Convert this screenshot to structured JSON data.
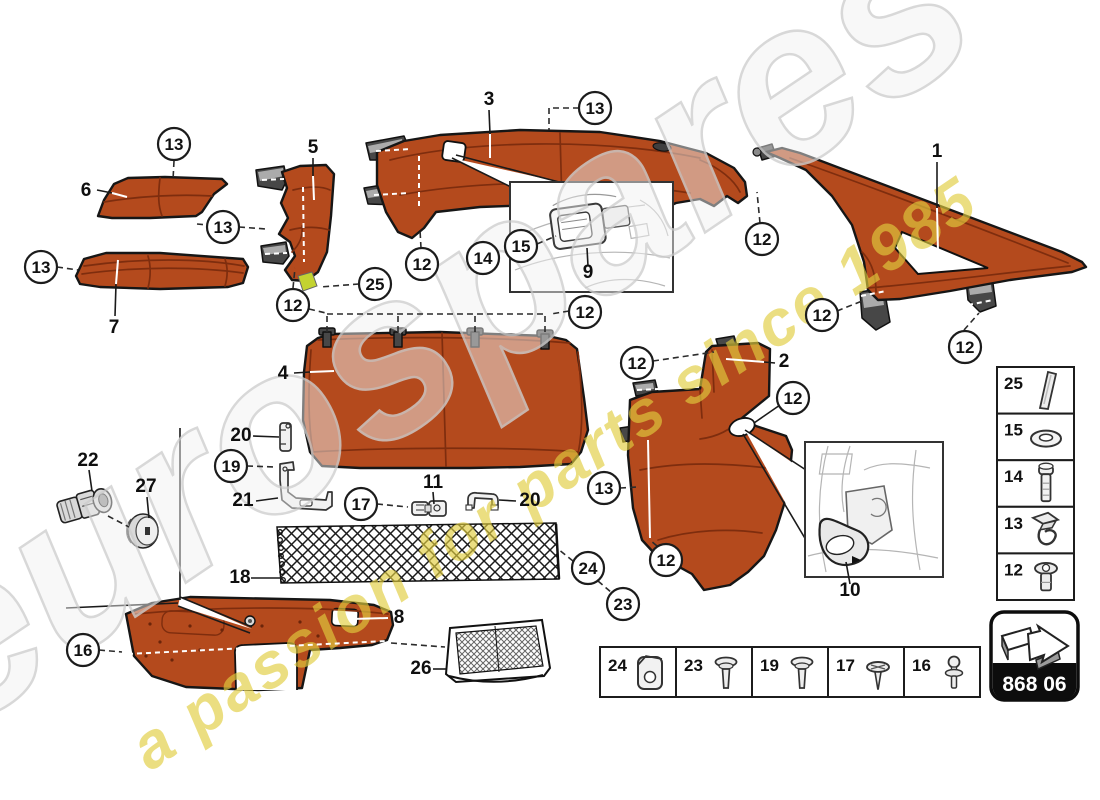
{
  "watermark": {
    "brand": "eurospares",
    "tagline": "a passion for parts since 1985",
    "tagline_color": "#e0cd3e"
  },
  "part_number_box": {
    "code": "868 06",
    "icon": "arrow-3d-icon"
  },
  "colors": {
    "trim": "#b44a1d",
    "trim_dark": "#7e2d0e",
    "outline": "#161616",
    "clip_dark": "#474747",
    "highlight_strip": "#c3d330"
  },
  "labels": [
    {
      "text": "6",
      "x": 86,
      "y": 196
    },
    {
      "text": "7",
      "x": 114,
      "y": 333
    },
    {
      "text": "5",
      "x": 313,
      "y": 153
    },
    {
      "text": "3",
      "x": 489,
      "y": 105
    },
    {
      "text": "1",
      "x": 937,
      "y": 157
    },
    {
      "text": "2",
      "x": 784,
      "y": 367
    },
    {
      "text": "4",
      "x": 283,
      "y": 379
    },
    {
      "text": "8",
      "x": 399,
      "y": 623
    },
    {
      "text": "9",
      "x": 588,
      "y": 278
    },
    {
      "text": "10",
      "x": 850,
      "y": 596
    },
    {
      "text": "11",
      "x": 433,
      "y": 488
    },
    {
      "text": "18",
      "x": 240,
      "y": 583
    },
    {
      "text": "20",
      "x": 241,
      "y": 441
    },
    {
      "text": "21",
      "x": 243,
      "y": 506
    },
    {
      "text": "20",
      "x": 530,
      "y": 506
    },
    {
      "text": "22",
      "x": 88,
      "y": 466
    },
    {
      "text": "26",
      "x": 421,
      "y": 674
    },
    {
      "text": "27",
      "x": 146,
      "y": 492
    }
  ],
  "callouts": [
    {
      "ref": "13",
      "x": 174,
      "y": 144
    },
    {
      "ref": "13",
      "x": 223,
      "y": 227
    },
    {
      "ref": "13",
      "x": 41,
      "y": 267
    },
    {
      "ref": "12",
      "x": 293,
      "y": 305
    },
    {
      "ref": "25",
      "x": 375,
      "y": 284
    },
    {
      "ref": "13",
      "x": 595,
      "y": 108
    },
    {
      "ref": "15",
      "x": 521,
      "y": 246
    },
    {
      "ref": "14",
      "x": 483,
      "y": 258
    },
    {
      "ref": "12",
      "x": 422,
      "y": 264
    },
    {
      "ref": "12",
      "x": 585,
      "y": 312
    },
    {
      "ref": "12",
      "x": 762,
      "y": 239
    },
    {
      "ref": "12",
      "x": 822,
      "y": 315
    },
    {
      "ref": "12",
      "x": 965,
      "y": 347
    },
    {
      "ref": "12",
      "x": 637,
      "y": 363
    },
    {
      "ref": "12",
      "x": 793,
      "y": 398
    },
    {
      "ref": "13",
      "x": 604,
      "y": 488
    },
    {
      "ref": "12",
      "x": 666,
      "y": 560
    },
    {
      "ref": "24",
      "x": 588,
      "y": 568
    },
    {
      "ref": "23",
      "x": 623,
      "y": 604
    },
    {
      "ref": "19",
      "x": 231,
      "y": 466
    },
    {
      "ref": "17",
      "x": 361,
      "y": 504
    },
    {
      "ref": "16",
      "x": 83,
      "y": 650
    }
  ],
  "fastener_sidebar": {
    "items": [
      {
        "ref": "25",
        "icon": "adhesive-strip-icon"
      },
      {
        "ref": "15",
        "icon": "washer-icon"
      },
      {
        "ref": "14",
        "icon": "bolt-icon"
      },
      {
        "ref": "13",
        "icon": "spring-clip-icon"
      },
      {
        "ref": "12",
        "icon": "push-rivet-icon"
      }
    ]
  },
  "fastener_legend": {
    "items": [
      {
        "ref": "24",
        "icon": "clamp-bracket-icon"
      },
      {
        "ref": "23",
        "icon": "rivet-icon"
      },
      {
        "ref": "19",
        "icon": "rivet-icon"
      },
      {
        "ref": "17",
        "icon": "screw-icon"
      },
      {
        "ref": "16",
        "icon": "ball-stud-icon"
      }
    ]
  }
}
